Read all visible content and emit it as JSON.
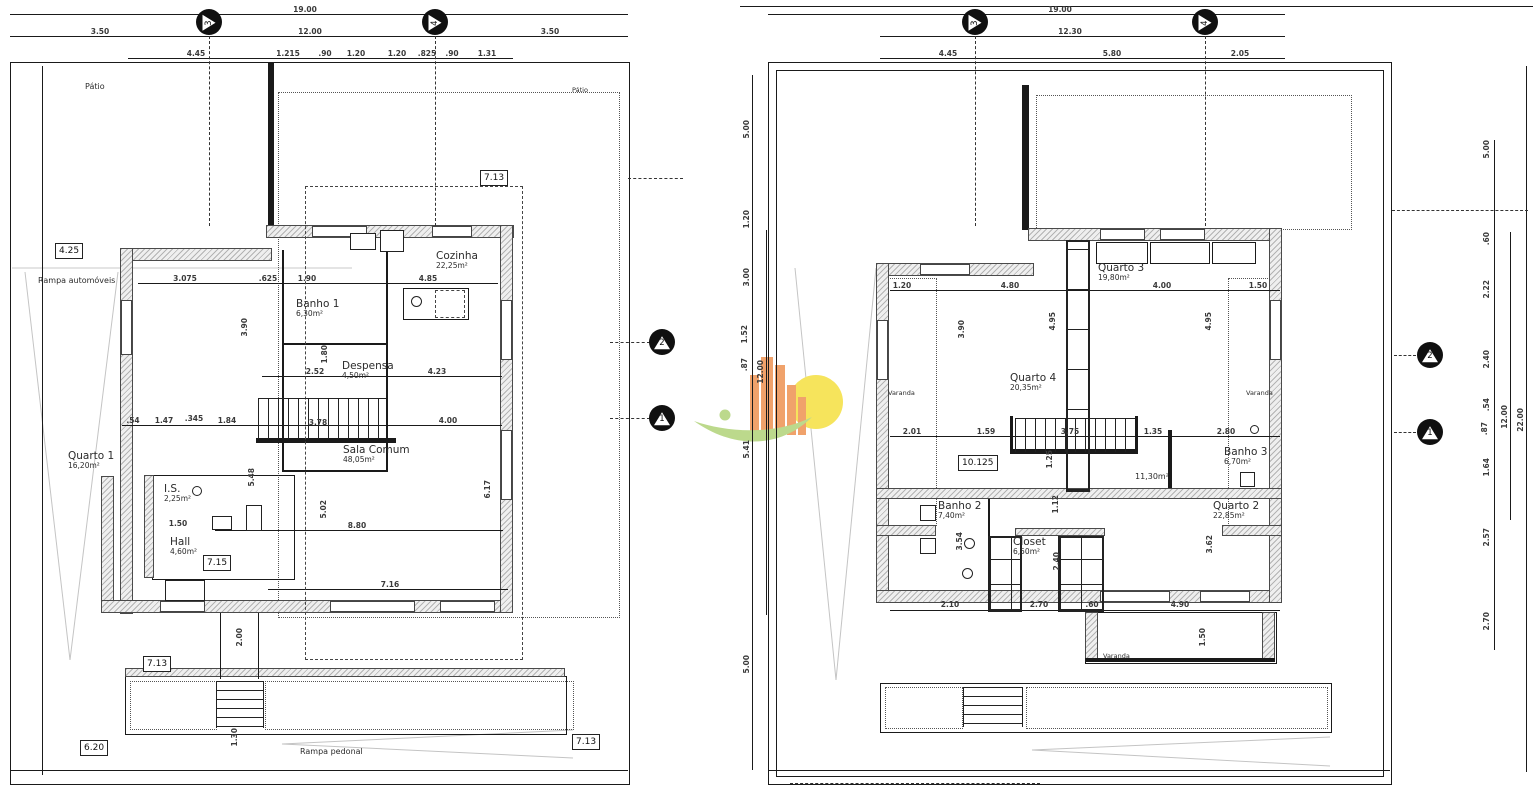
{
  "site": {
    "patio": "Pátio",
    "rampa_automoveis": "Rampa automóveis",
    "rampa_pedonal": "Rampa pedonal",
    "varanda": "Varanda"
  },
  "markers": {
    "c1": "1",
    "c2": "2",
    "c3": "3",
    "c4": "4"
  },
  "watermark": {
    "building": "#f0a26b",
    "sun": "#f6e45c",
    "leaf": "#bcd98c"
  },
  "left_plan": {
    "top": {
      "total": "19.00",
      "inner": "12.00",
      "left": "3.50",
      "right": "3.50",
      "sub": [
        "4.45",
        "1.215",
        ".90",
        "1.20",
        "1.20",
        ".825",
        ".90",
        "1.31"
      ]
    },
    "boxes": {
      "b425": "4.25",
      "b713a": "7.13",
      "b715": "7.15",
      "b713b": "7.13",
      "b620": "6.20",
      "b713c": "7.13"
    },
    "rooms": {
      "quarto1": {
        "name": "Quarto 1",
        "area": "16,20m²"
      },
      "banho1": {
        "name": "Banho 1",
        "area": "6,30m²"
      },
      "despensa": {
        "name": "Despensa",
        "area": "4,50m²"
      },
      "cozinha": {
        "name": "Cozinha",
        "area": "22,25m²"
      },
      "sala": {
        "name": "Sala Comum",
        "area": "48,05m²"
      },
      "is": {
        "name": "I.S.",
        "area": "2,25m²"
      },
      "hall": {
        "name": "Hall",
        "area": "4,60m²"
      }
    },
    "dims": {
      "d3075": "3.075",
      "d625": ".625",
      "d190": "1.90",
      "d485": "4.85",
      "d390": "3.90",
      "d252": "2.52",
      "d423": "4.23",
      "d180": "1.80",
      "d054": ".54",
      "d147": "1.47",
      "d345": ".345",
      "d184": "1.84",
      "d378": "3.78",
      "d400": "4.00",
      "d880": "8.80",
      "d150": "1.50",
      "d548": "5.48",
      "d502": "5.02",
      "d617": "6.17",
      "d716": "7.16",
      "d200": "2.00",
      "d130": "1.30"
    }
  },
  "right_plan": {
    "top": {
      "total": "19.00",
      "inner": "12.30",
      "sub": [
        "4.45",
        "5.80",
        "2.05"
      ]
    },
    "left_chain": [
      "5.00",
      "1.20",
      "3.00",
      "1.52",
      ".87",
      "5.41",
      "5.00"
    ],
    "left_total": "12.00",
    "right_chain": [
      "5.00",
      ".60",
      "2.22",
      "2.40",
      ".54",
      ".87",
      "1.64",
      "2.57",
      "2.70"
    ],
    "right_totals": [
      "12.00",
      "22.00"
    ],
    "boxes": {
      "b10125": "10.125"
    },
    "rooms": {
      "quarto3": {
        "name": "Quarto 3",
        "area": "19,80m²"
      },
      "quarto4": {
        "name": "Quarto 4",
        "area": "20,35m²"
      },
      "banho2": {
        "name": "Banho 2",
        "area": "7,40m²"
      },
      "banho3": {
        "name": "Banho 3",
        "area": "6,70m²"
      },
      "closet": {
        "name": "Closet",
        "area": "6,50m²"
      },
      "quarto2": {
        "name": "Quarto 2",
        "area": "22,85m²"
      },
      "circulation_area": "11,30m²"
    },
    "dims": {
      "d120": "1.20",
      "d480": "4.80",
      "d400": "4.00",
      "d150": "1.50",
      "d390": "3.90",
      "d495a": "4.95",
      "d495b": "4.95",
      "d201": "2.01",
      "d159": "1.59",
      "d375": "3.75",
      "d135": "1.35",
      "d280": "2.80",
      "d125": "1.25",
      "d112": "1.12",
      "d240": "2.40",
      "d354": "3.54",
      "d362": "3.62",
      "d210": "2.10",
      "d270": "2.70",
      "d060": ".60",
      "d490": "4.90",
      "d150v": "1.50"
    }
  }
}
